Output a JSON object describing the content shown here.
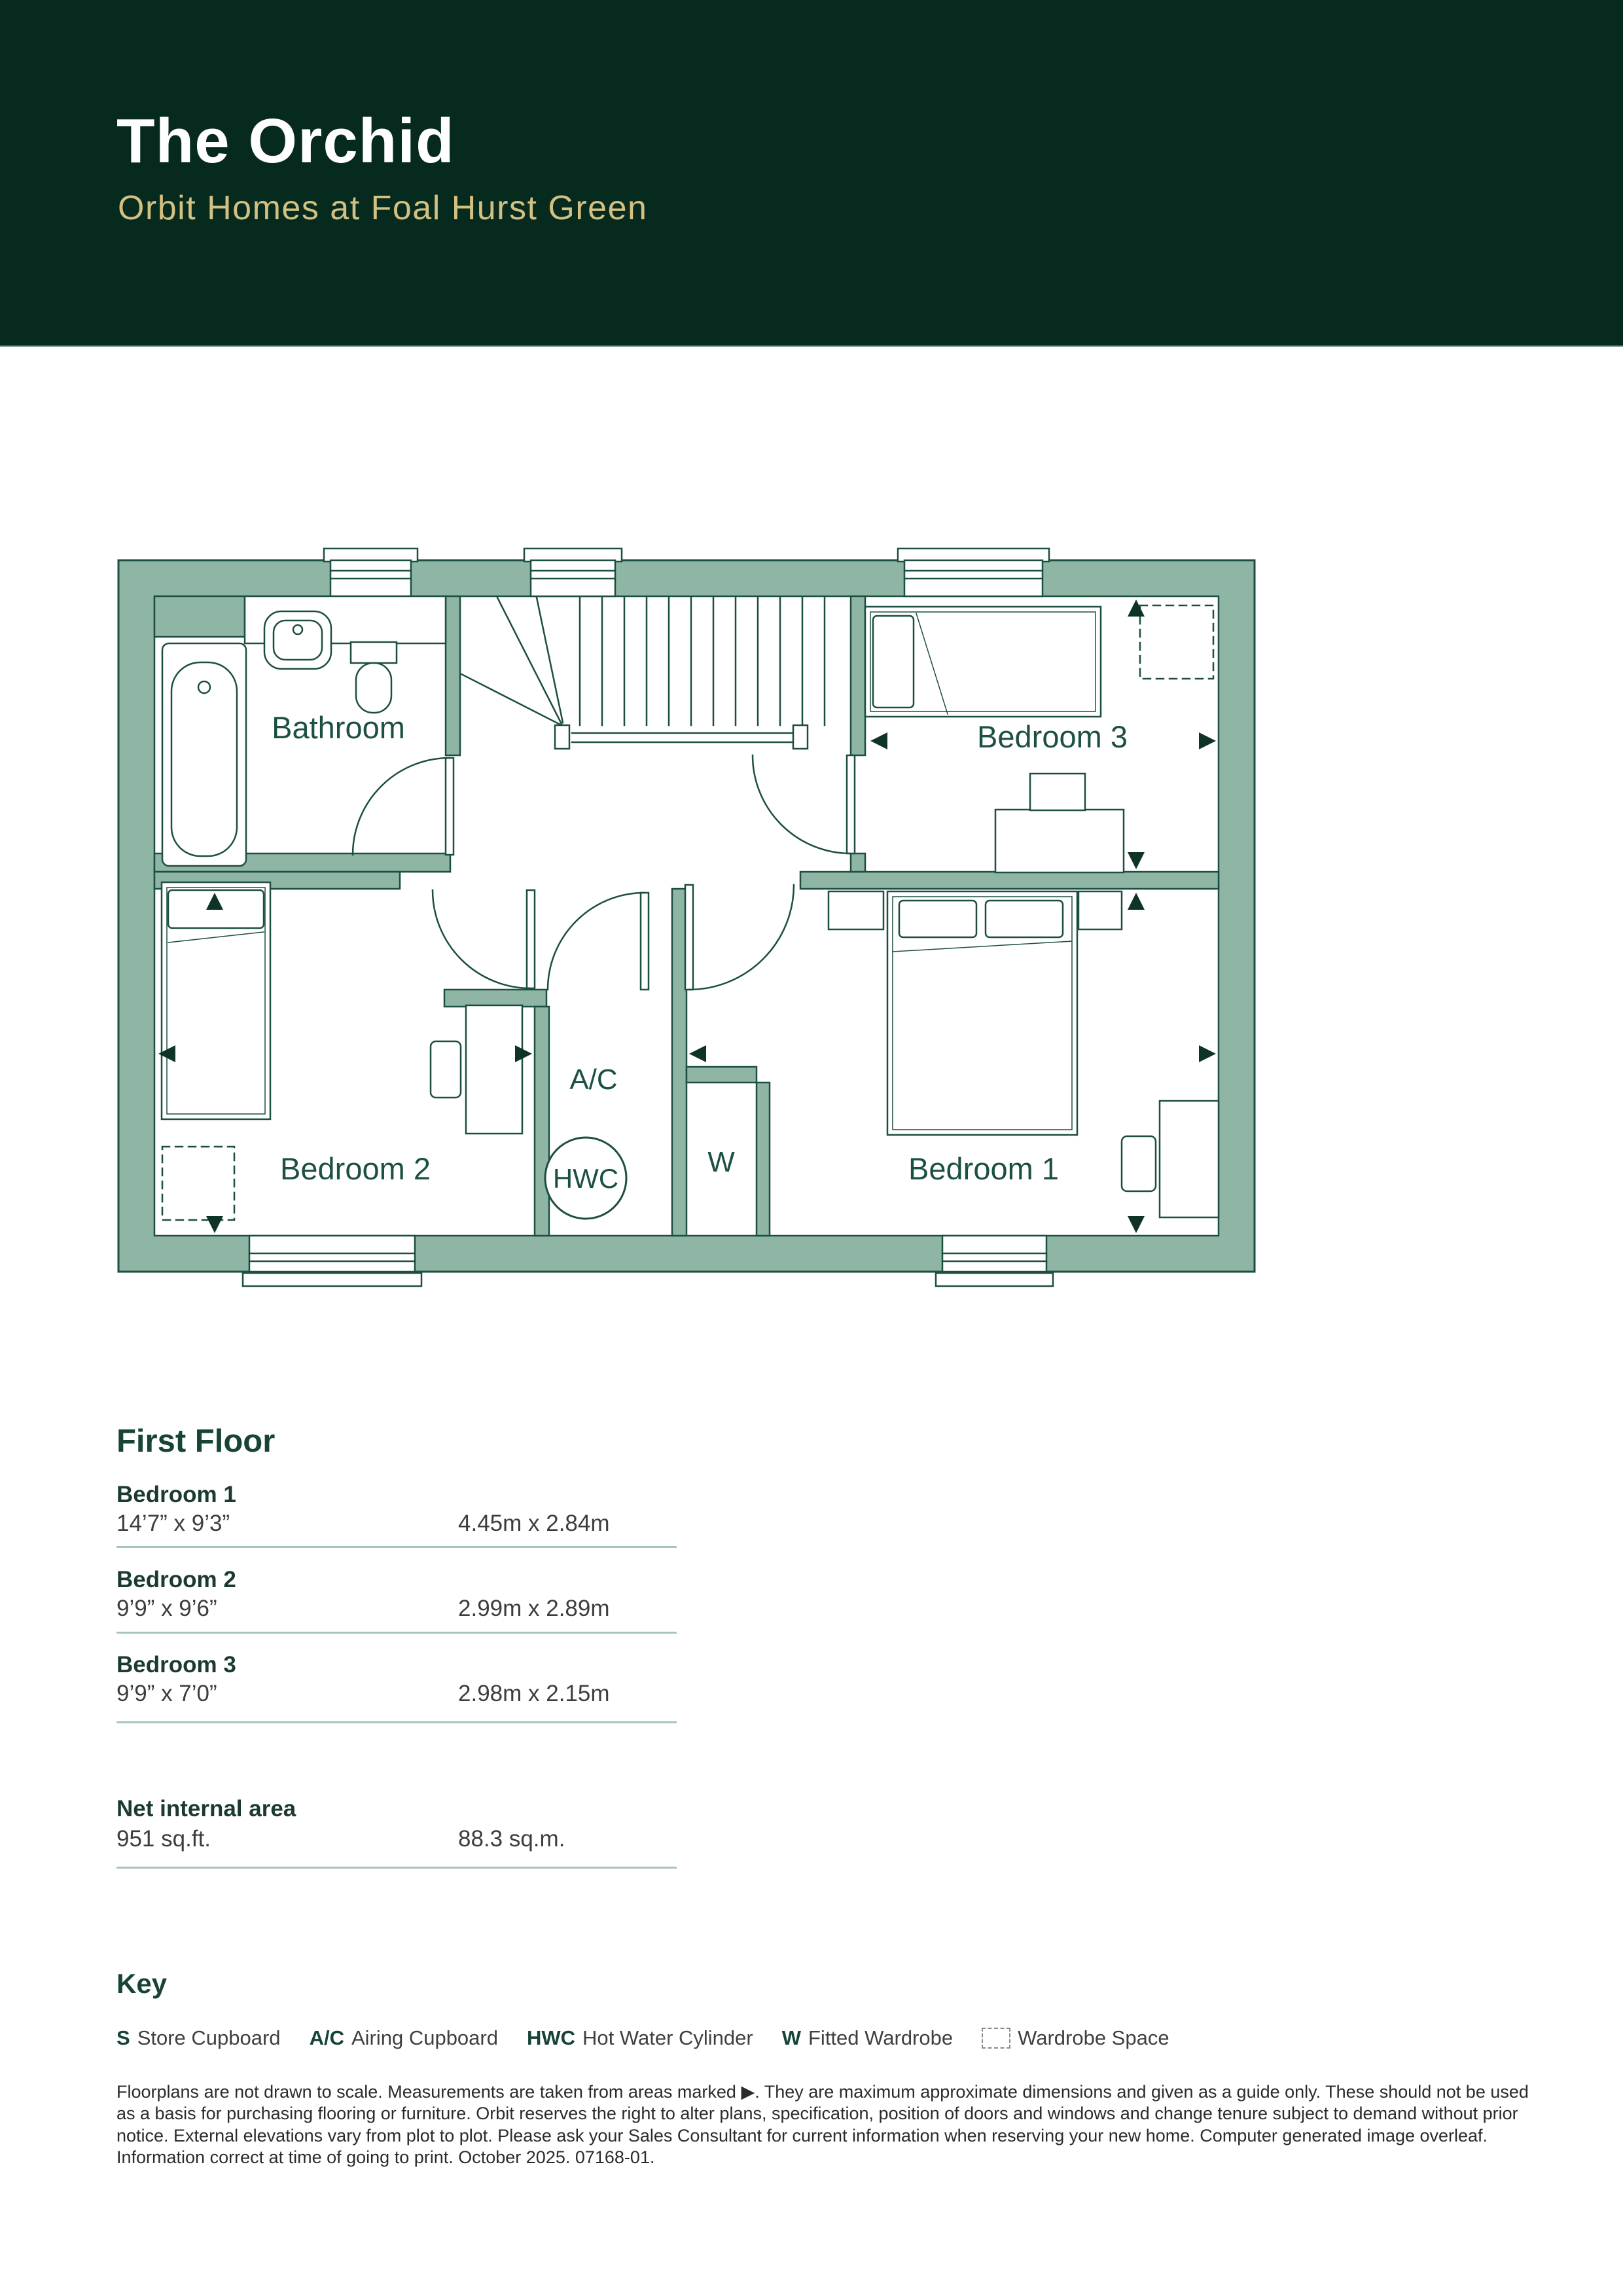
{
  "header": {
    "title": "The Orchid",
    "subtitle": "Orbit Homes at Foal Hurst Green"
  },
  "plan": {
    "labels": {
      "bathroom": "Bathroom",
      "bedroom3": "Bedroom 3",
      "bedroom2": "Bedroom 2",
      "bedroom1": "Bedroom 1",
      "airing": "A/C",
      "hwc": "HWC",
      "wardrobe": "W"
    }
  },
  "floor": {
    "title": "First Floor",
    "rows": [
      {
        "name": "Bedroom 1",
        "imperial": "14’7” x 9’3”",
        "metric": "4.45m x 2.84m"
      },
      {
        "name": "Bedroom 2",
        "imperial": "9’9” x 9’6”",
        "metric": "2.99m x 2.89m"
      },
      {
        "name": "Bedroom 3",
        "imperial": "9’9” x 7’0”",
        "metric": "2.98m x 2.15m"
      }
    ],
    "net": {
      "label": "Net internal area",
      "imperial": "951 sq.ft.",
      "metric": "88.3 sq.m."
    }
  },
  "key": {
    "title": "Key",
    "items": [
      {
        "abbr": "S",
        "label": "Store Cupboard"
      },
      {
        "abbr": "A/C",
        "label": "Airing Cupboard"
      },
      {
        "abbr": "HWC",
        "label": "Hot Water Cylinder"
      },
      {
        "abbr": "W",
        "label": "Fitted Wardrobe"
      },
      {
        "abbr": "",
        "label": "Wardrobe Space"
      }
    ]
  },
  "disclaimer": "Floorplans are not drawn to scale. Measurements are taken from areas marked ▶. They are maximum approximate dimensions and given as a guide only. These should not be used as a basis for purchasing flooring or furniture. Orbit reserves the right to alter plans, specification, position of doors and windows and change tenure subject to demand without prior notice. External elevations vary from plot to plot. Please ask your Sales Consultant for current information when reserving your new home. Computer generated image overleaf. Information correct at time of going to print. October 2025. 07168-01.",
  "colors": {
    "band": "#062a1e",
    "gold": "#d3c083",
    "wall": "#8fb6a4",
    "line": "#1c4f41"
  }
}
